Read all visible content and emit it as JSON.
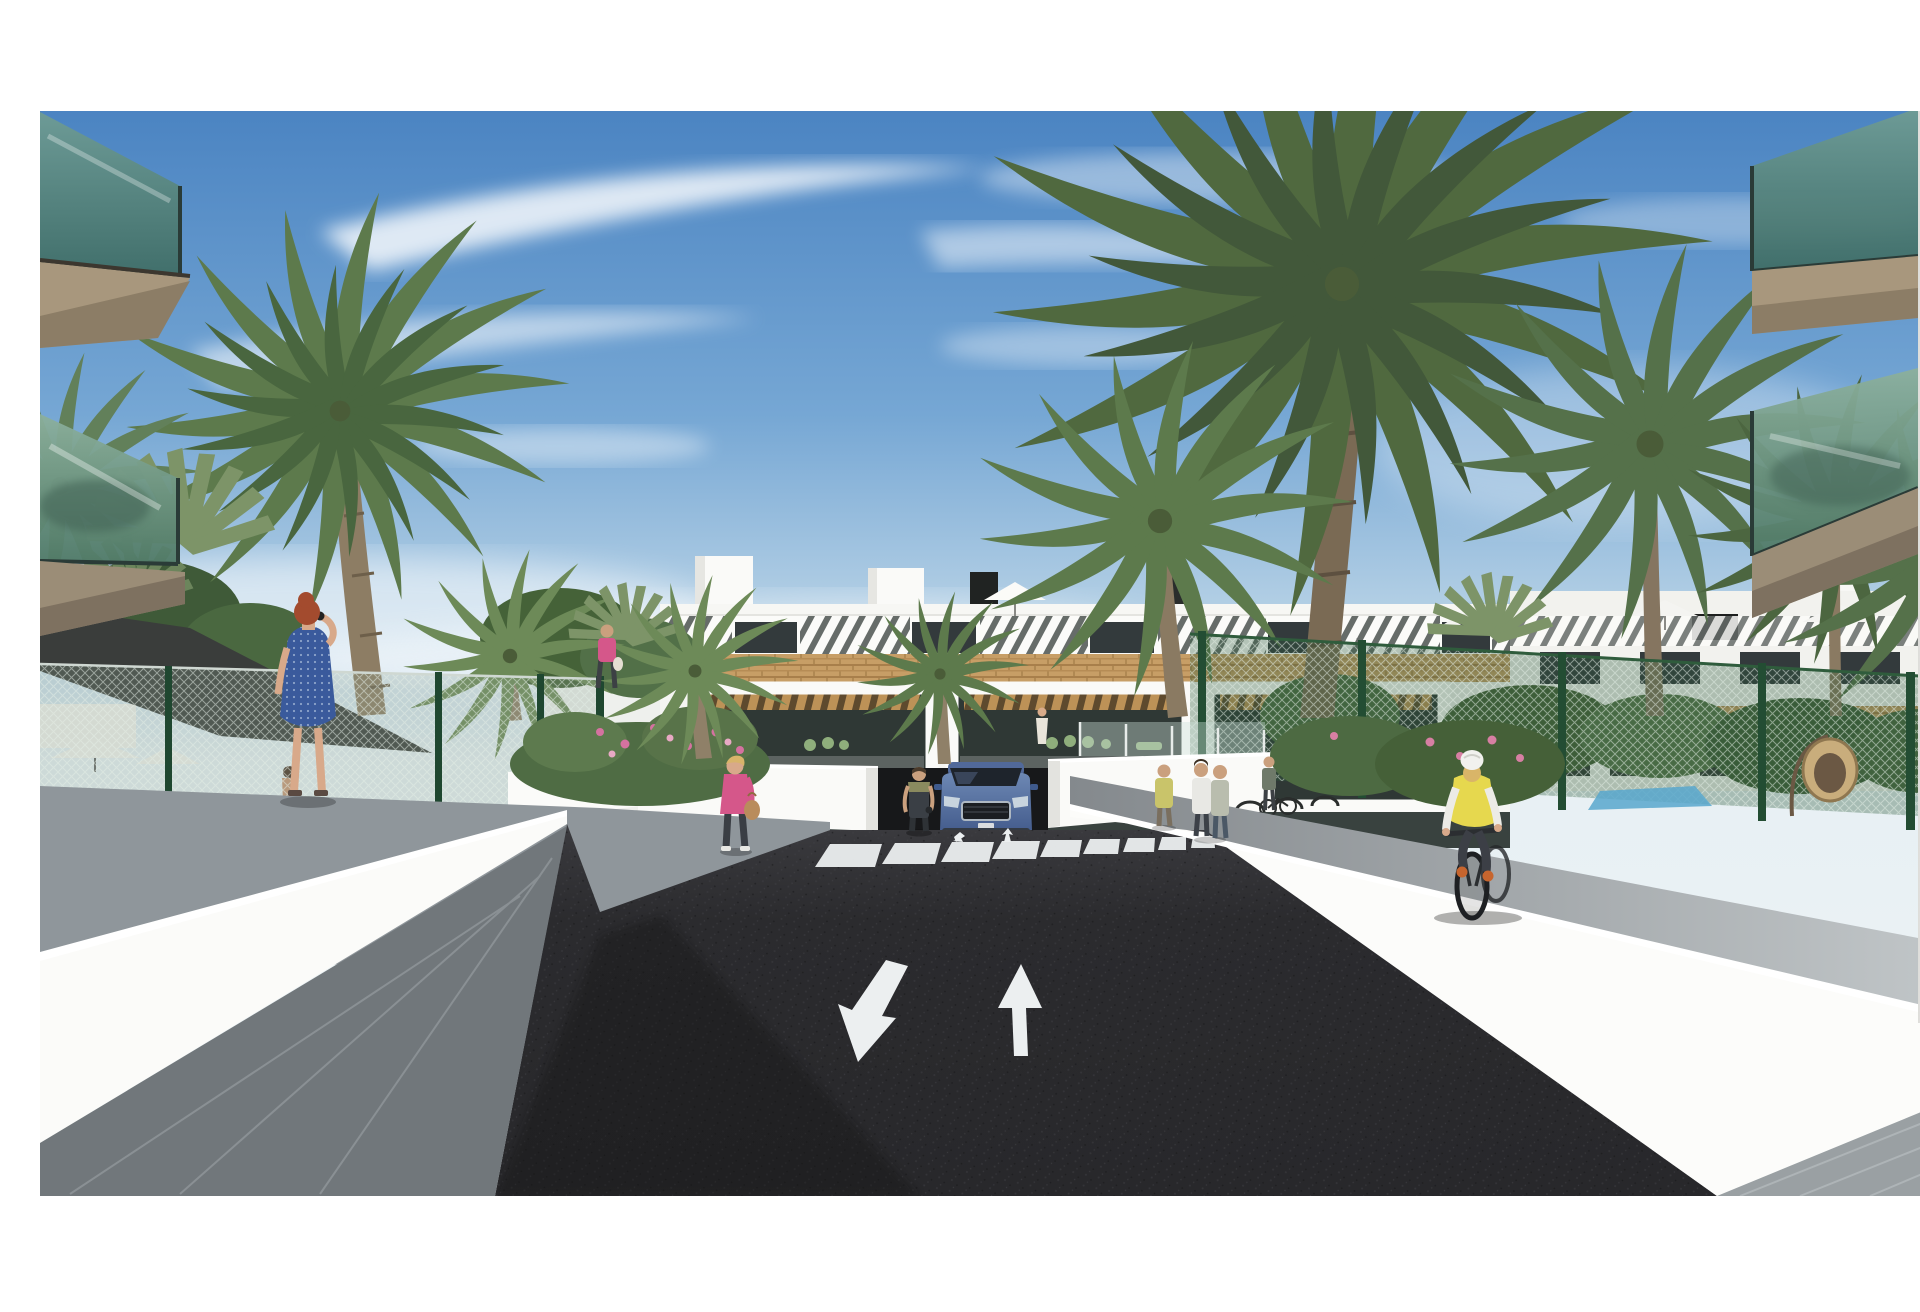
{
  "meta": {
    "title": "New-build apartment complex — street rendering",
    "description": "Architectural 3D visualization: palm-lined asphalt driveway with zebra crossing and painted lane arrows leading to a three-storey white apartment residence with striped sun awnings, a brick band and timber pergola terraces. A blue SUV exits an underground garage ramp, pedestrians walk along white concrete ramp walls, a cyclist in a yellow vest rides the right-hand walkway, and a fenced pool garden with white parasols and a shade sail sits on the left, all under a blue sky with thin clouds."
  },
  "labels": {
    "sky": "blue sky with thin white clouds",
    "building": "three-storey white apartment building with striped sun awnings, brick band and timber pergola terraces",
    "right_wing": "second apartment wing with rooftop parasols",
    "balcony_left": "foreground glass balconies, top left",
    "balcony_right": "foreground glass balconies, top right",
    "column_right": "white building column, right edge",
    "palms": "palm trees",
    "fence_left": "mesh garden fence, left pool area",
    "fence_right": "green mesh garden fence, right garden",
    "shade_sail": "dark shade sail over pool terrace",
    "pool_area": "pool garden with white parasols",
    "pool_water": "glimpse of pool water",
    "egg_chair": "hanging wicker egg chair",
    "wicker_bench": "wicker bench by the pool fence",
    "road": "dark asphalt entrance driveway",
    "crosswalk": "zebra crossing",
    "arrow_down": "lane arrow pointing toward viewer",
    "arrow_up": "lane arrow pointing away from viewer",
    "mini_arrows": "small painted arrows at the crossing",
    "ramp": "underground garage ramp opening",
    "car": "blue SUV leaving the garage ramp",
    "bike_racks": "bicycle stands with parked bikes",
    "planter": "flowering planter bed",
    "wall_left": "white concrete ramp wall, left",
    "wall_right": "white concrete ramp wall, right",
    "walkway_left": "grey walkway, left side",
    "walkway_right": "grey walkway, right side",
    "pavement_left": "paved corner, bottom left",
    "pavement_right": "paved corner, bottom right",
    "woman_blue": "red-haired woman in blue dress talking on the phone",
    "woman_pink": "blonde woman in pink jacket carrying a handbag",
    "woman_pink_small": "woman in pink top near the planter",
    "person_overalls": "person in dark overalls beside the ramp",
    "pedestrian_group": "pedestrians chatting near the bike stands",
    "terrace_figure": "resident on a first-floor terrace",
    "pool_man": "man by the pool behind the fence",
    "cyclist": "cyclist in yellow vest and white helmet"
  },
  "palette": {
    "sky_top": "#4b84c2",
    "sky_horizon": "#e7f0f4",
    "cloud": "#ffffff",
    "building_white": "#f6f6f3",
    "awning_stripe_shadow": "#666c69",
    "window_dark": "#333a3c",
    "brick": "#c79e66",
    "pergola_wood": "#bd9257",
    "terrace_glass": "#2f3835",
    "terrace_furniture_green": "#8fae7c",
    "balcony_glass_teal": "#5c8a84",
    "balcony_slab_tan": "#a8977d",
    "fence_green": "#2f5c3c",
    "palm_frond": "#5d7a4c",
    "palm_frond_dark": "#50693f",
    "palm_trunk": "#8d7d64",
    "shade_sail_gray": "#3a3d3b",
    "wall_white": "#fbfbf9",
    "walkway_gray": "#8f969b",
    "pavement_dark_gray": "#71777b",
    "asphalt": "#28282b",
    "road_marking": "#eceff0",
    "car_blue": "#4e6da0",
    "pool_water": "#58a7cc",
    "vest_yellow": "#e6d84e",
    "dress_blue": "#3a5a9c",
    "jacket_pink": "#d5578a",
    "hair_red": "#a34b2e",
    "skin": "#d8a98a",
    "wicker": "#c9ad7c"
  }
}
